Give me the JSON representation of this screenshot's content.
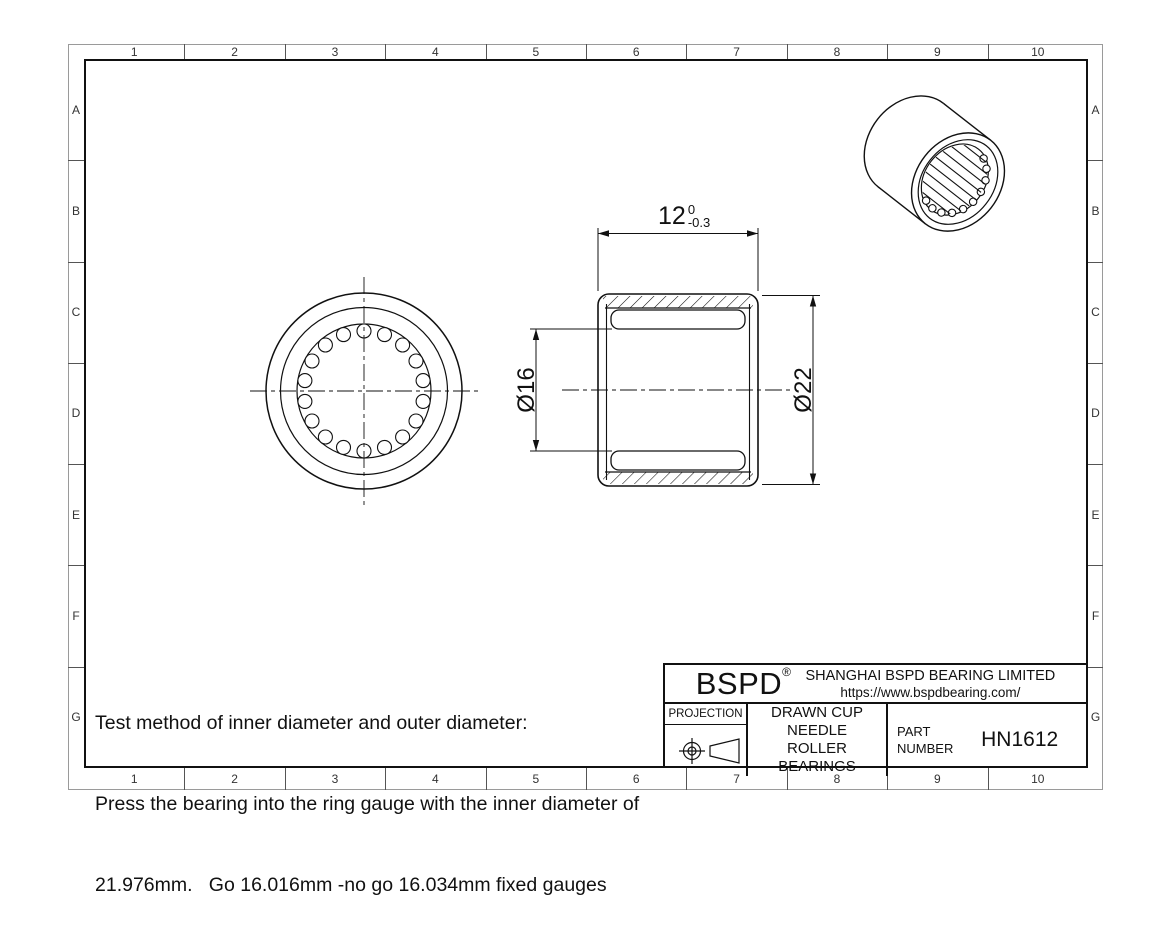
{
  "colors": {
    "line": "#111111",
    "background": "#ffffff",
    "border_outer": "#9a9a9a"
  },
  "grid": {
    "columns": [
      "1",
      "2",
      "3",
      "4",
      "5",
      "6",
      "7",
      "8",
      "9",
      "10"
    ],
    "rows": [
      "A",
      "B",
      "C",
      "D",
      "E",
      "F",
      "G"
    ]
  },
  "notes": {
    "line1": "Test method of inner diameter and outer diameter:",
    "line2": "Press the bearing into the ring gauge with the inner diameter of",
    "line3": "21.976mm.   Go 16.016mm -no go 16.034mm fixed gauges"
  },
  "dimensions": {
    "length": {
      "value": "12",
      "tol_upper": "0",
      "tol_lower": "-0.3"
    },
    "bore": "Ø16",
    "outer": "Ø22"
  },
  "views": {
    "front": {
      "roller_count": 18
    },
    "iso": {
      "roller_line_count": 8,
      "scallop_count": 10
    }
  },
  "title_block": {
    "brand": "BSPD",
    "registered": "®",
    "company": "SHANGHAI BSPD BEARING LIMITED",
    "website": "https://www.bspdbearing.com/",
    "projection_label": "PROJECTION",
    "product_line1": "DRAWN CUP NEEDLE",
    "product_line2": "ROLLER BEARINGS",
    "part_label1": "PART",
    "part_label2": "NUMBER",
    "part_number": "HN1612"
  }
}
